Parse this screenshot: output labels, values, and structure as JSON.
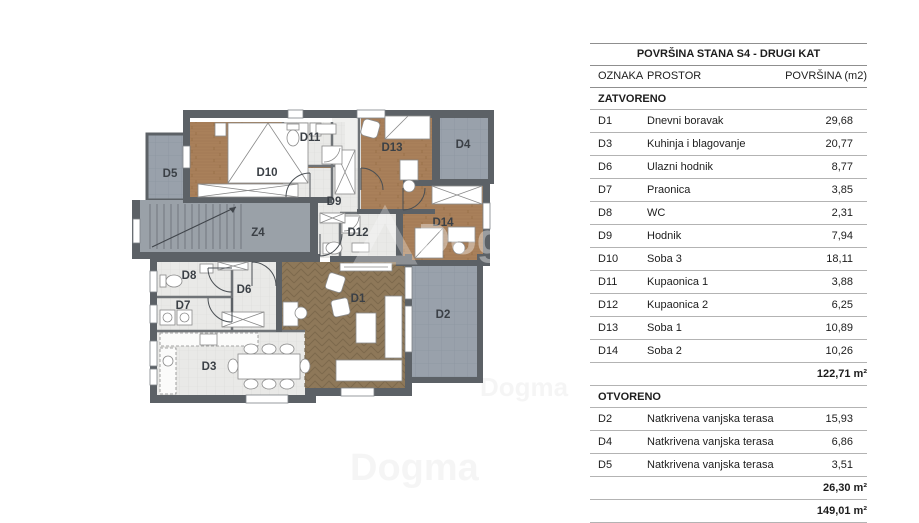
{
  "plan": {
    "labels": {
      "D1": "D1",
      "D2": "D2",
      "D3": "D3",
      "D4": "D4",
      "D5": "D5",
      "D6": "D6",
      "D7": "D7",
      "D8": "D8",
      "D9": "D9",
      "D10": "D10",
      "D11": "D11",
      "D12": "D12",
      "D13": "D13",
      "D14": "D14",
      "Z4": "Z4"
    },
    "watermark": {
      "brand": "Dogma",
      "sub": "nekretnine"
    },
    "colors": {
      "wall": "#5c6166",
      "wood": "#a9805a",
      "herringbone": "#8e7859",
      "tile": "#e9e9e7",
      "terrace": "#99a1ab",
      "stairwell": "#9aa1a8"
    }
  },
  "table": {
    "title": "POVRŠINA STANA S4 - DRUGI KAT",
    "columns": {
      "code": "OZNAKA",
      "space": "PROSTOR",
      "area": "POVRŠINA (m2)"
    },
    "sections": [
      {
        "name": "ZATVORENO",
        "rows": [
          {
            "code": "D1",
            "space": "Dnevni boravak",
            "area": "29,68"
          },
          {
            "code": "D3",
            "space": "Kuhinja i blagovanje",
            "area": "20,77"
          },
          {
            "code": "D6",
            "space": "Ulazni hodnik",
            "area": "8,77"
          },
          {
            "code": "D7",
            "space": "Praonica",
            "area": "3,85"
          },
          {
            "code": "D8",
            "space": "WC",
            "area": "2,31"
          },
          {
            "code": "D9",
            "space": "Hodnik",
            "area": "7,94"
          },
          {
            "code": "D10",
            "space": "Soba 3",
            "area": "18,11"
          },
          {
            "code": "D11",
            "space": "Kupaonica 1",
            "area": "3,88"
          },
          {
            "code": "D12",
            "space": "Kupaonica 2",
            "area": "6,25"
          },
          {
            "code": "D13",
            "space": "Soba 1",
            "area": "10,89"
          },
          {
            "code": "D14",
            "space": "Soba 2",
            "area": "10,26"
          }
        ],
        "subtotal": "122,71 m²"
      },
      {
        "name": "OTVORENO",
        "rows": [
          {
            "code": "D2",
            "space": "Natkrivena vanjska terasa",
            "area": "15,93"
          },
          {
            "code": "D4",
            "space": "Natkrivena vanjska terasa",
            "area": "6,86"
          },
          {
            "code": "D5",
            "space": "Natkrivena vanjska terasa",
            "area": "3,51"
          }
        ],
        "subtotal": "26,30 m²"
      }
    ],
    "total": "149,01 m²"
  }
}
